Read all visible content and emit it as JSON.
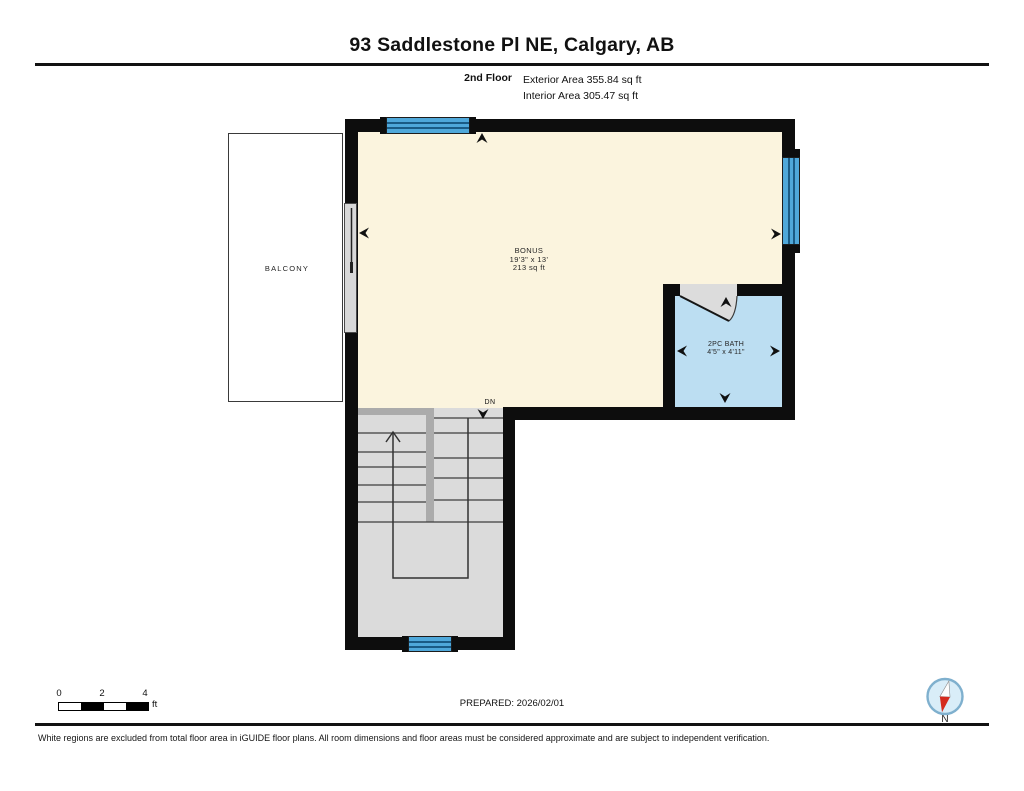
{
  "header": {
    "title": "93 Saddlestone Pl NE, Calgary, AB",
    "floor_label": "2nd Floor",
    "exterior_area": "Exterior Area 355.84 sq ft",
    "interior_area": "Interior Area 305.47 sq ft"
  },
  "plan": {
    "rooms": {
      "bonus": {
        "name": "BONUS",
        "dimensions": "19'3\" x 13'",
        "area": "213 sq ft"
      },
      "bath": {
        "name": "2PC BATH",
        "dimensions": "4'5\" x 4'11\""
      },
      "balcony": {
        "name": "BALCONY"
      }
    },
    "stairs": {
      "down_label": "DN"
    }
  },
  "footer": {
    "scale": {
      "ticks": [
        "0",
        "2",
        "4"
      ],
      "unit": "ft"
    },
    "prepared": "PREPARED: 2026/02/01",
    "compass_label": "N",
    "disclaimer": "White regions are excluded from total floor area in iGUIDE floor plans. All room dimensions and floor areas must be considered approximate and are subject to independent verification."
  },
  "colors": {
    "wall": "#0d0d0d",
    "bonus_fill": "#FBF4DE",
    "bath_fill": "#BCDEF2",
    "window_blue": "#4FA8DA",
    "window_stripe": "#1A5B85",
    "stair_fill": "#DBDBDB",
    "stair_halfwall": "#ABABAB",
    "door_gray": "#D8D8D8",
    "compass_ring": "#7FB0CE",
    "compass_fill": "#D9EDF8",
    "compass_needle_red": "#D42B1E"
  }
}
